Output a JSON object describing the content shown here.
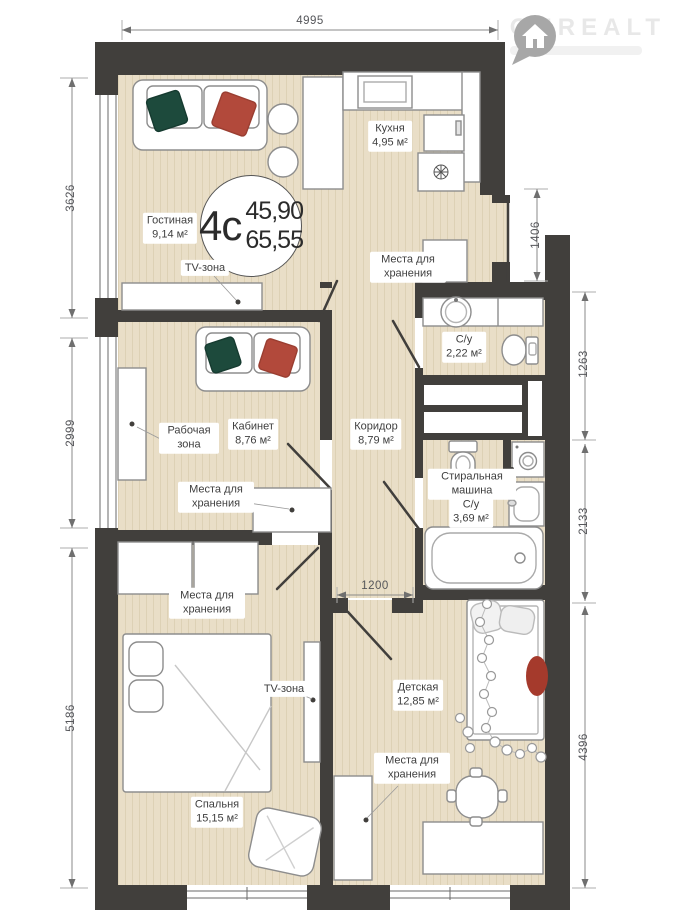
{
  "logo": {
    "brand": "ONREALT"
  },
  "plan_badge": {
    "type_label": "4с",
    "area_living": "45,90",
    "area_total": "65,55"
  },
  "rooms": {
    "living": {
      "name": "Гостиная",
      "area": "9,14 м²"
    },
    "kitchen": {
      "name": "Кухня",
      "area": "4,95 м²"
    },
    "office": {
      "name": "Кабинет",
      "area": "8,76 м²"
    },
    "corridor": {
      "name": "Коридор",
      "area": "8,79 м²"
    },
    "bathroom_small": {
      "name": "С/у",
      "area": "2,22 м²"
    },
    "bathroom_large": {
      "name": "С/у",
      "area": "3,69 м²"
    },
    "kids": {
      "name": "Детская",
      "area": "12,85 м²"
    },
    "bedroom": {
      "name": "Спальня",
      "area": "15,15 м²"
    }
  },
  "zones": {
    "tv_living": "TV-зона",
    "tv_bedroom": "TV-зона",
    "work": "Рабочая зона",
    "storage_hall": "Места для хранения",
    "storage_office": "Места для хранения",
    "storage_bedroom": "Места для хранения",
    "storage_kids": "Места для хранения",
    "washer": "Стиральная машина"
  },
  "dimensions": {
    "top": "4995",
    "left_top": "3626",
    "left_mid": "2999",
    "left_bottom": "5186",
    "right_niche": "1406",
    "right_top": "1263",
    "right_mid": "2133",
    "right_bottom": "4396",
    "inner_corridor": "1200"
  },
  "colors": {
    "wall": "#413f3c",
    "floor": "#e9dec7",
    "accent_green": "#1d4a3c",
    "accent_red": "#b2493b"
  }
}
